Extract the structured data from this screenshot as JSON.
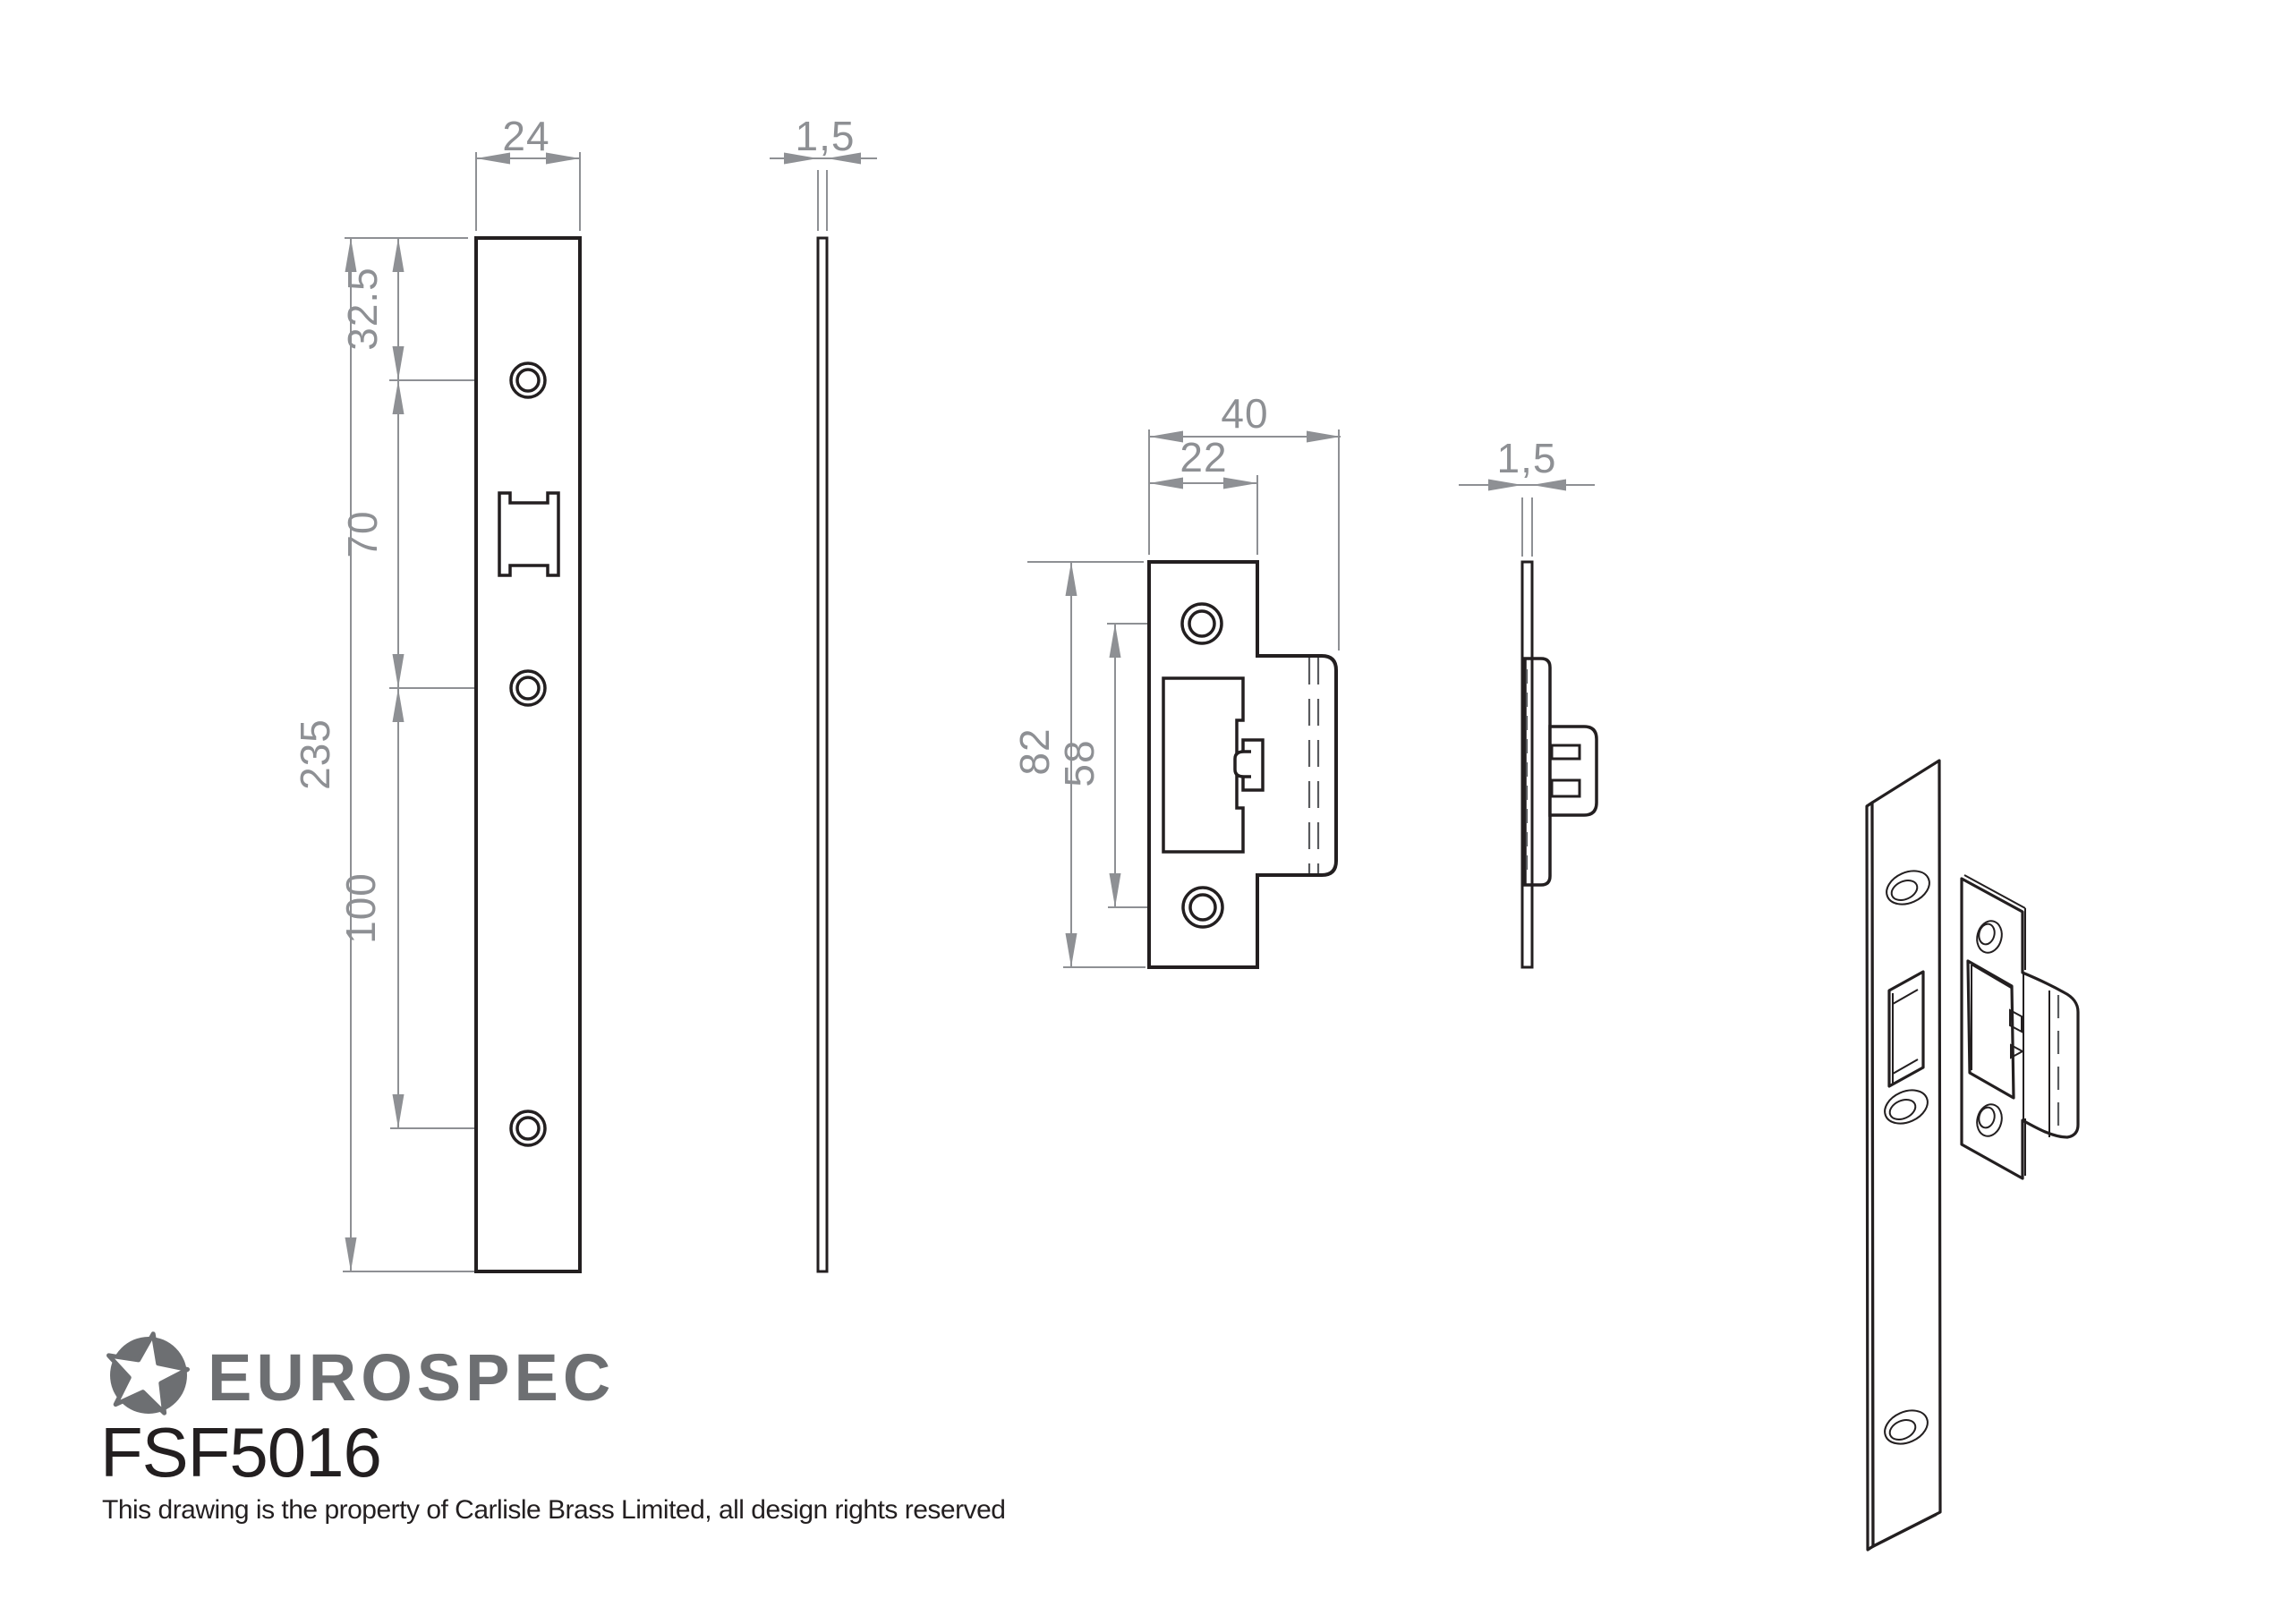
{
  "branding": {
    "name": "EUROSPEC",
    "logo_icon": "star-in-circle",
    "product_code": "FSF5016",
    "copyright": "This drawing is the property of Carlisle Brass Limited, all design rights reserved",
    "brand_color": "#6d6f72"
  },
  "drawing": {
    "background": "#ffffff",
    "line_color": "#231f20",
    "dimension_color": "#8e9094",
    "hidden_line_color": "#595b5e"
  },
  "views": {
    "forend_front": {
      "dimensions": {
        "width": "24",
        "overall_height": "235",
        "top_to_first_hole": "32.5",
        "first_to_second_hole": "70",
        "second_to_third_hole": "100"
      }
    },
    "forend_side": {
      "dimensions": {
        "thickness": "1,5"
      }
    },
    "strike_front": {
      "dimensions": {
        "overall_width": "40",
        "plate_width": "22",
        "overall_height": "82",
        "hole_centres": "58"
      }
    },
    "strike_side": {
      "dimensions": {
        "thickness": "1,5"
      }
    }
  }
}
